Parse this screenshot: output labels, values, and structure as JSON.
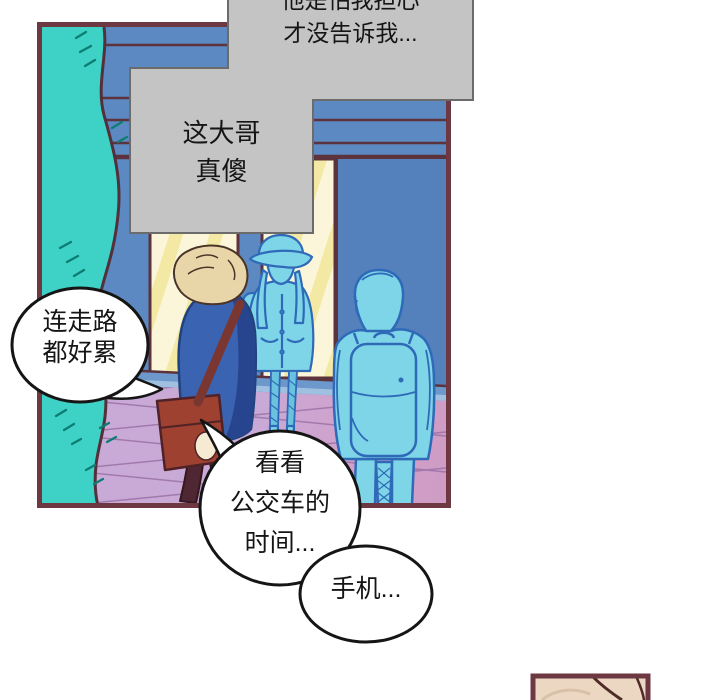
{
  "page": {
    "kind": "webtoon comic page fragment",
    "background": "#ffffff"
  },
  "captions": [
    {
      "id": "caption-1",
      "text": "他是怕我担心\n才没告诉我..."
    },
    {
      "id": "caption-2",
      "text": "这大哥\n真傻"
    }
  ],
  "speech_bubbles": [
    {
      "id": "bubble-left",
      "speaker": "blond-boy",
      "text": "连走路\n都好累"
    },
    {
      "id": "bubble-bus",
      "speaker": "blond-boy",
      "text": "看看\n公交车的\n时间..."
    },
    {
      "id": "bubble-phone",
      "speaker": "blond-boy",
      "text": "手机..."
    }
  ],
  "panel": {
    "content": [
      "teal-tree",
      "storefront-windows",
      "blue-building",
      "tiled-pavement",
      "blond-boy-with-red-bag",
      "hatted-person-with-backpack",
      "backpack-person"
    ]
  },
  "colors": {
    "panel_border": "#6e3842",
    "tree": "#3dd2c5",
    "tree_hatch": "#0d7d74",
    "building_blue": "#5c89c2",
    "right_wall_blue": "#5480bc",
    "facade_line": "#5c333c",
    "window_glass": "#fbf5da",
    "window_stripe": "#f4e9a4",
    "baseboard_blue": "#6d98cc",
    "floor_purple": "#c9a9d5",
    "floor_pink": "#cf9cc5",
    "floor_line": "#9b72a6",
    "character_blue": "#7ed5e8",
    "character_outline": "#2f6ab8",
    "hair_blond": "#e9d6a8",
    "skin": "#f6ead2",
    "jacket_blue": "#3a63b2",
    "jacket_shade": "#27458e",
    "bag_red": "#9f4130",
    "pants_maroon": "#4e2732",
    "caption_bg": "#c4c4c4",
    "caption_border": "#6b6b6b",
    "bubble_fill": "#ffffff",
    "bubble_outline": "#151515",
    "mini_panel_bg": "#ecd8c2",
    "mini_panel_line": "#4f2b28"
  }
}
